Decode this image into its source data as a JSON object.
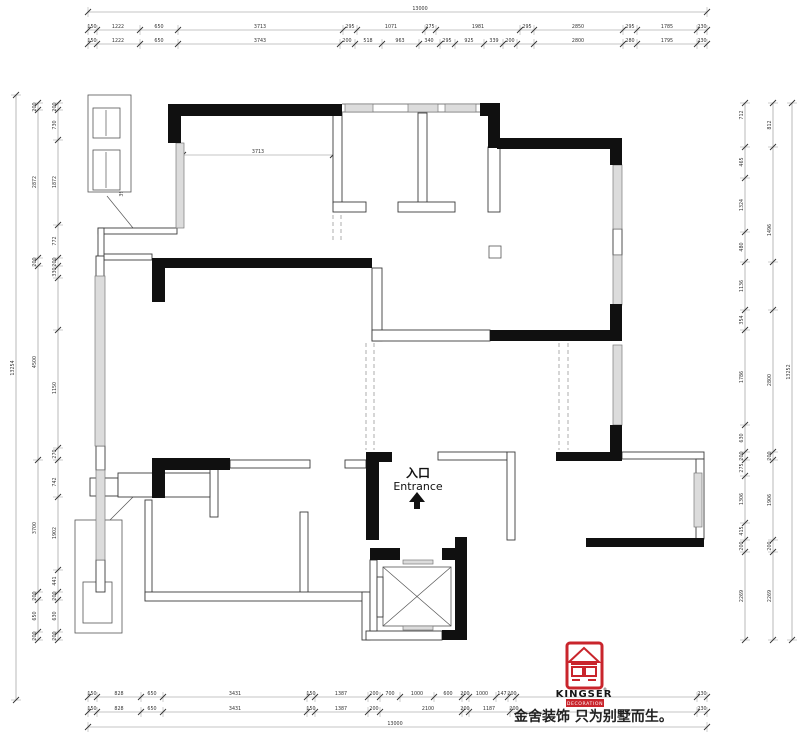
{
  "drawing": {
    "type": "residential floor plan",
    "entrance": {
      "cn": "入口",
      "en": "Entrance"
    },
    "logo": {
      "brand": "KINGSER",
      "registered": "®",
      "sub": "DECORATION",
      "slogan": "金舍装饰 只为别墅而生。",
      "brand_color": "#c9252c"
    },
    "annot_labels": [
      [
        106,
        124,
        "740"
      ],
      [
        123,
        146,
        "100"
      ],
      [
        106,
        172,
        "1000"
      ],
      [
        123,
        192,
        "390"
      ]
    ],
    "dims": {
      "top_total": {
        "o": "h",
        "c": 12,
        "a": 88,
        "b": 707,
        "t": [
          88,
          707
        ],
        "l": [
          [
            420,
            "13000"
          ]
        ]
      },
      "top_row1": {
        "o": "h",
        "c": 30,
        "a": 88,
        "b": 707,
        "t": [
          88,
          97,
          140,
          178,
          343,
          357,
          425,
          436,
          520,
          534,
          623,
          637,
          697,
          707
        ],
        "l": [
          [
            92,
            "150"
          ],
          [
            118,
            "1222"
          ],
          [
            159,
            "650"
          ],
          [
            260,
            "3713"
          ],
          [
            350,
            "295"
          ],
          [
            391,
            "1071"
          ],
          [
            430,
            "275"
          ],
          [
            478,
            "1981"
          ],
          [
            527,
            "295"
          ],
          [
            578,
            "2850"
          ],
          [
            630,
            "295"
          ],
          [
            667,
            "1785"
          ],
          [
            702,
            "230"
          ]
        ]
      },
      "top_row2": {
        "o": "h",
        "c": 44,
        "a": 88,
        "b": 707,
        "t": [
          88,
          97,
          140,
          178,
          340,
          355,
          382,
          419,
          440,
          455,
          484,
          503,
          517,
          534,
          623,
          637,
          697,
          707
        ],
        "l": [
          [
            92,
            "150"
          ],
          [
            118,
            "1222"
          ],
          [
            159,
            "650"
          ],
          [
            260,
            "3743"
          ],
          [
            347,
            "200"
          ],
          [
            368,
            "518"
          ],
          [
            400,
            "963"
          ],
          [
            429,
            "340"
          ],
          [
            447,
            "295"
          ],
          [
            469,
            "925"
          ],
          [
            494,
            "339"
          ],
          [
            510,
            "200"
          ],
          [
            578,
            "2800"
          ],
          [
            630,
            "280"
          ],
          [
            667,
            "1795"
          ],
          [
            702,
            "230"
          ]
        ]
      },
      "room_width": {
        "o": "h",
        "c": 155,
        "a": 183,
        "b": 333,
        "t": [
          183,
          333
        ],
        "l": [
          [
            258,
            "3713"
          ]
        ]
      },
      "bot_row1": {
        "o": "h",
        "c": 697,
        "a": 88,
        "b": 707,
        "t": [
          88,
          97,
          141,
          163,
          307,
          315,
          368,
          380,
          400,
          434,
          462,
          469,
          496,
          508,
          516,
          697,
          707
        ],
        "l": [
          [
            92,
            "150"
          ],
          [
            119,
            "828"
          ],
          [
            152,
            "650"
          ],
          [
            235,
            "3431"
          ],
          [
            311,
            "150"
          ],
          [
            341,
            "1387"
          ],
          [
            374,
            "200"
          ],
          [
            390,
            "700"
          ],
          [
            417,
            "1000"
          ],
          [
            448,
            "600"
          ],
          [
            465,
            "200"
          ],
          [
            482,
            "1000"
          ],
          [
            502,
            "147"
          ],
          [
            512,
            "200"
          ],
          [
            702,
            "230"
          ]
        ]
      },
      "bot_row2": {
        "o": "h",
        "c": 712,
        "a": 88,
        "b": 707,
        "t": [
          88,
          97,
          141,
          163,
          307,
          315,
          368,
          380,
          462,
          469,
          510,
          518,
          697,
          707
        ],
        "l": [
          [
            92,
            "150"
          ],
          [
            119,
            "828"
          ],
          [
            152,
            "650"
          ],
          [
            235,
            "3431"
          ],
          [
            311,
            "150"
          ],
          [
            341,
            "1387"
          ],
          [
            374,
            "200"
          ],
          [
            428,
            "2100"
          ],
          [
            465,
            "200"
          ],
          [
            489,
            "1187"
          ],
          [
            514,
            "200"
          ],
          [
            702,
            "230"
          ]
        ]
      },
      "bot_total": {
        "o": "h",
        "c": 727,
        "a": 88,
        "b": 707,
        "t": [
          88,
          707
        ],
        "l": [
          [
            395,
            "13000"
          ]
        ]
      },
      "left_total": {
        "o": "v",
        "c": 16,
        "a": 95,
        "b": 700,
        "t": [
          95,
          700
        ],
        "l": [
          [
            368,
            "13254"
          ]
        ]
      },
      "left_mid": {
        "o": "v",
        "c": 38,
        "a": 103,
        "b": 640,
        "t": [
          103,
          110,
          258,
          266,
          460,
          592,
          600,
          632,
          640
        ],
        "l": [
          [
            107,
            "200"
          ],
          [
            182,
            "2872"
          ],
          [
            262,
            "200"
          ],
          [
            362,
            "4500"
          ],
          [
            528,
            "3700"
          ],
          [
            596,
            "200"
          ],
          [
            616,
            "650"
          ],
          [
            636,
            "200"
          ]
        ]
      },
      "left_in": {
        "o": "v",
        "c": 58,
        "a": 103,
        "b": 640,
        "t": [
          103,
          110,
          140,
          225,
          258,
          266,
          278,
          330,
          448,
          460,
          497,
          570,
          592,
          600,
          632,
          640
        ],
        "l": [
          [
            107,
            "200"
          ],
          [
            125,
            "730"
          ],
          [
            182,
            "1872"
          ],
          [
            241,
            "772"
          ],
          [
            262,
            "200"
          ],
          [
            272,
            "330"
          ],
          [
            388,
            "1150"
          ],
          [
            454,
            "270"
          ],
          [
            482,
            "742"
          ],
          [
            533,
            "1902"
          ],
          [
            581,
            "441"
          ],
          [
            596,
            "200"
          ],
          [
            616,
            "630"
          ],
          [
            636,
            "200"
          ]
        ]
      },
      "right_in": {
        "o": "v",
        "c": 745,
        "a": 103,
        "b": 640,
        "t": [
          103,
          147,
          178,
          232,
          262,
          310,
          330,
          425,
          452,
          460,
          476,
          523,
          540,
          552,
          640
        ],
        "l": [
          [
            115,
            "712"
          ],
          [
            162,
            "465"
          ],
          [
            205,
            "1324"
          ],
          [
            247,
            "480"
          ],
          [
            286,
            "1136"
          ],
          [
            320,
            "354"
          ],
          [
            377,
            "1786"
          ],
          [
            438,
            "630"
          ],
          [
            456,
            "200"
          ],
          [
            468,
            "275"
          ],
          [
            499,
            "1306"
          ],
          [
            531,
            "415"
          ],
          [
            546,
            "200"
          ],
          [
            596,
            "2269"
          ]
        ]
      },
      "right_mid": {
        "o": "v",
        "c": 773,
        "a": 103,
        "b": 640,
        "t": [
          103,
          147,
          262,
          310,
          452,
          460,
          540,
          552,
          640
        ],
        "l": [
          [
            125,
            "812"
          ],
          [
            230,
            "1496"
          ],
          [
            380,
            "2800"
          ],
          [
            456,
            "200"
          ],
          [
            500,
            "1906"
          ],
          [
            546,
            "200"
          ],
          [
            596,
            "2269"
          ]
        ]
      },
      "right_total": {
        "o": "v",
        "c": 792,
        "a": 103,
        "b": 640,
        "t": [
          103,
          640
        ],
        "l": [
          [
            372,
            "13252"
          ]
        ]
      }
    }
  }
}
